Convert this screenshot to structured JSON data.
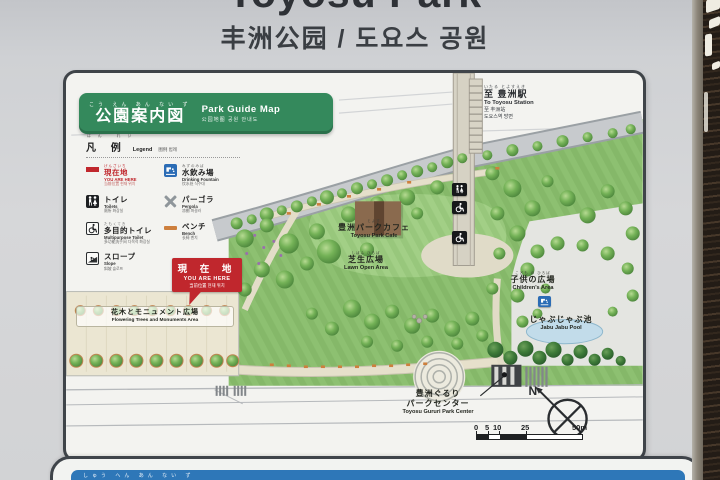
{
  "sign": {
    "title": "Toyosu Park",
    "subtitle": "丰洲公园 / 도요스 공원"
  },
  "map_header": {
    "furigana": "こう えん あん ない ず",
    "title": "公園案内図",
    "title_en": "Park Guide Map",
    "title_sub": "公园地图  공원 안내도"
  },
  "station": {
    "furigana": "いたる とよすえき",
    "jp": "至 豊洲駅",
    "en": "To Toyosu Station",
    "zh": "至 丰洲站",
    "ko": "도요스역 방면"
  },
  "legend": {
    "header_jp": "凡 例",
    "header_furigana": "はん れい",
    "header_en": "Legend",
    "header_sub": "图例  범례",
    "items": [
      {
        "icon": "you-are-here-marker",
        "furigana": "げんざいち",
        "jp": "現在地",
        "en": "YOU ARE HERE",
        "sub": "当前位置 현재 위치"
      },
      {
        "icon": "drinking-fountain-icon",
        "furigana": "みずのみば",
        "jp": "水飲み場",
        "en": "Drinking Fountain",
        "sub": "饮水处 식수대"
      },
      {
        "icon": "toilets-icon",
        "furigana": "",
        "jp": "トイレ",
        "en": "Toilets",
        "sub": "厕所 화장실"
      },
      {
        "icon": "pergola-icon",
        "furigana": "",
        "jp": "パーゴラ",
        "en": "Pergola",
        "sub": "凉棚 퍼걸러"
      },
      {
        "icon": "multipurpose-toilet-icon",
        "furigana": "たもくてき",
        "jp": "多目的トイレ",
        "en": "Multipurpose Toilet",
        "sub": "多功能洗手间 다목적 화장실"
      },
      {
        "icon": "bench-icon",
        "furigana": "",
        "jp": "ベンチ",
        "en": "Bench",
        "sub": "长椅 벤치"
      },
      {
        "icon": "slope-icon",
        "furigana": "",
        "jp": "スロープ",
        "en": "Slope",
        "sub": "斜坡 슬로프"
      }
    ]
  },
  "you_are_here_box": {
    "jp": "現 在 地",
    "en": "YOU ARE HERE",
    "sub": "当前位置  현재 위치"
  },
  "map_labels": {
    "cafe": {
      "furigana": "とよす",
      "jp": "豊洲パークカフェ",
      "en": "Toyosu Park Cafe"
    },
    "lawn": {
      "furigana": "しばふ ひろば",
      "jp": "芝生広場",
      "en": "Lawn Open Area"
    },
    "children": {
      "furigana": "こども の ひろば",
      "jp": "子供の広場",
      "en": "Children's Area"
    },
    "pool": {
      "jp": "じゃぶじゃぶ池",
      "en": "Jabu Jabu Pool"
    },
    "flowering": {
      "jp": "花木とモニュメント広場",
      "en": "Flowering Trees and Monuments Area"
    },
    "park_center": {
      "jp1": "豊洲ぐるり",
      "jp2": "パークセンター",
      "en": "Toyosu Gururi Park Center"
    }
  },
  "map_markers": {
    "walkway_toilets": "toilets-icon",
    "walkway_accessible_upper": "wheelchair-icon",
    "walkway_accessible_lower": "wheelchair-icon",
    "pool_fountain": "drinking-fountain-icon"
  },
  "compass": {
    "north_label": "N"
  },
  "scale": {
    "labels": [
      "0",
      "5",
      "10",
      "25",
      "50m"
    ]
  },
  "bottom_sign": {
    "furigana": "しゅう へん あん ない ず"
  },
  "colors": {
    "header_green": "#34895c",
    "you_are_here_red": "#c0272d",
    "fountain_blue": "#2b6cb5",
    "bench_orange": "#cd7f3d",
    "board_border": "#3f4449",
    "bottom_header_blue": "#2e77b8",
    "park_green": "#86b969"
  }
}
